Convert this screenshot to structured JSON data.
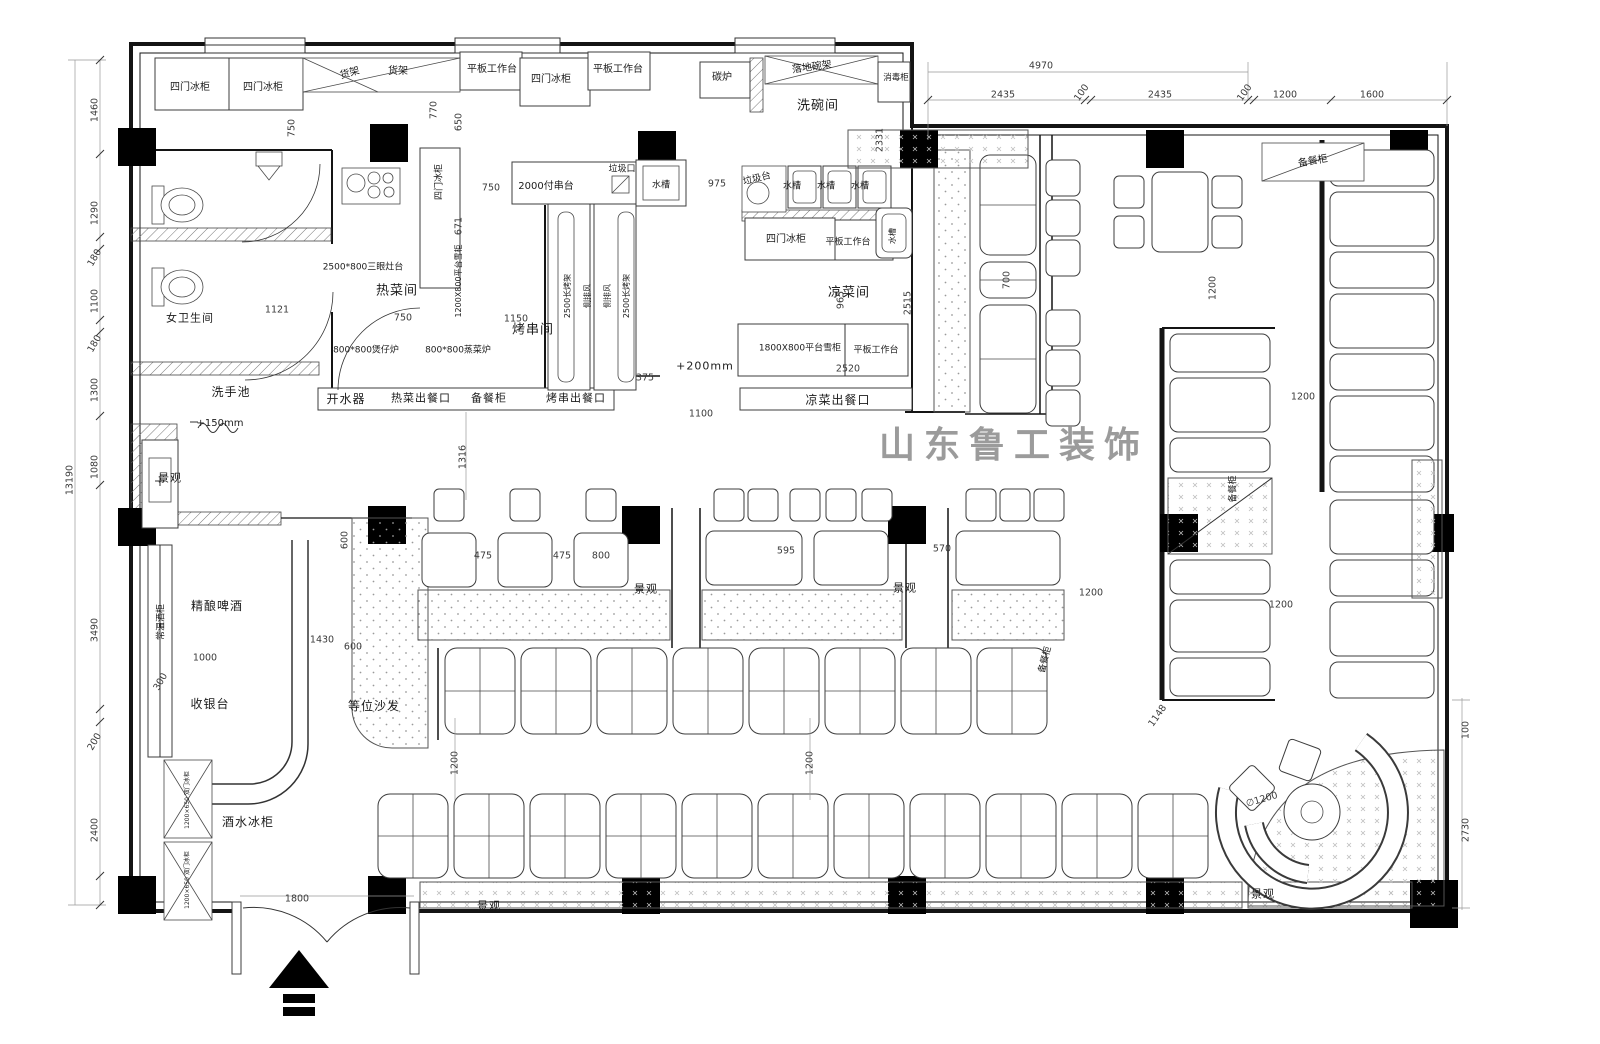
{
  "title": "restaurant-floor-plan",
  "watermark": "山东鲁工装饰",
  "entrance": {
    "width_label": "1800"
  },
  "labels": [
    {
      "id": "fridge-4door-1",
      "t": "四门冰柜",
      "x": 190,
      "y": 88,
      "c": "e"
    },
    {
      "id": "fridge-4door-2",
      "t": "四门冰柜",
      "x": 263,
      "y": 88,
      "c": "e"
    },
    {
      "id": "shelf-rack-1",
      "t": "货架",
      "x": 350,
      "y": 74,
      "r": -16,
      "c": "e"
    },
    {
      "id": "shelf-rack-2",
      "t": "货架",
      "x": 398,
      "y": 72,
      "c": "e"
    },
    {
      "id": "worktable-1",
      "t": "平板工作台",
      "x": 492,
      "y": 70,
      "c": "e"
    },
    {
      "id": "fridge-4door-3",
      "t": "四门冰柜",
      "x": 551,
      "y": 80,
      "c": "e"
    },
    {
      "id": "worktable-2",
      "t": "平板工作台",
      "x": 618,
      "y": 70,
      "c": "e"
    },
    {
      "id": "charcoal-stove",
      "t": "碳炉",
      "x": 722,
      "y": 78,
      "c": "e"
    },
    {
      "id": "floor-dish-rack",
      "t": "落地碗架",
      "x": 812,
      "y": 68,
      "r": -8,
      "c": "e"
    },
    {
      "id": "sterilizer-cabinet",
      "t": "消毒柜",
      "x": 896,
      "y": 78,
      "c": "e",
      "fs": 8.5
    },
    {
      "id": "dishwash-room",
      "t": "洗碗间",
      "x": 818,
      "y": 106,
      "c": "rm"
    },
    {
      "id": "trash-port",
      "t": "垃圾口",
      "x": 622,
      "y": 170,
      "c": "e",
      "fs": 9
    },
    {
      "id": "sink-1",
      "t": "水槽",
      "x": 661,
      "y": 186,
      "c": "e",
      "fs": 9
    },
    {
      "id": "skewer-counter",
      "t": "2000付串台",
      "x": 546,
      "y": 187,
      "c": "e"
    },
    {
      "id": "fridge-4door-4",
      "t": "四门冰柜",
      "x": 440,
      "y": 182,
      "r": -90,
      "c": "e",
      "fs": 9
    },
    {
      "id": "trash-table",
      "t": "垃圾台",
      "x": 757,
      "y": 179,
      "r": -14,
      "c": "e",
      "fs": 9.5
    },
    {
      "id": "sink-2",
      "t": "水槽",
      "x": 792,
      "y": 187,
      "c": "e",
      "fs": 9
    },
    {
      "id": "sink-3",
      "t": "水槽",
      "x": 826,
      "y": 187,
      "c": "e",
      "fs": 9
    },
    {
      "id": "sink-4",
      "t": "水槽",
      "x": 860,
      "y": 187,
      "c": "e",
      "fs": 9
    },
    {
      "id": "fridge-4door-5",
      "t": "四门冰柜",
      "x": 786,
      "y": 240,
      "c": "e"
    },
    {
      "id": "worktable-3",
      "t": "平板工作台",
      "x": 848,
      "y": 243,
      "c": "e",
      "fs": 9
    },
    {
      "id": "sink-5",
      "t": "水槽",
      "x": 893,
      "y": 236,
      "r": -90,
      "c": "e",
      "fs": 8
    },
    {
      "id": "stove-3eye",
      "t": "2500*800三眼灶台",
      "x": 363,
      "y": 268,
      "c": "e",
      "fs": 9
    },
    {
      "id": "hot-dish-room",
      "t": "热菜间",
      "x": 397,
      "y": 291,
      "c": "rm"
    },
    {
      "id": "platform-freezer-1",
      "t": "1200X800平台雪柜",
      "x": 459,
      "y": 281,
      "r": -90,
      "c": "e",
      "fs": 8
    },
    {
      "id": "bbq-skewer-room",
      "t": "烤串间",
      "x": 533,
      "y": 330,
      "c": "rm"
    },
    {
      "id": "claypot-stove",
      "t": "800*800煲仔炉",
      "x": 366,
      "y": 351,
      "c": "e",
      "fs": 9
    },
    {
      "id": "steam-stove",
      "t": "800*800蒸菜炉",
      "x": 458,
      "y": 351,
      "c": "e",
      "fs": 9
    },
    {
      "id": "grill-rack-1",
      "t": "2500长烤架",
      "x": 568,
      "y": 296,
      "r": -90,
      "c": "e",
      "fs": 8
    },
    {
      "id": "side-vent-1",
      "t": "侧排风",
      "x": 588,
      "y": 296,
      "r": -90,
      "c": "e",
      "fs": 8
    },
    {
      "id": "side-vent-2",
      "t": "侧排风",
      "x": 608,
      "y": 296,
      "r": -90,
      "c": "e",
      "fs": 8
    },
    {
      "id": "grill-rack-2",
      "t": "2500长烤架",
      "x": 627,
      "y": 296,
      "r": -90,
      "c": "e",
      "fs": 8
    },
    {
      "id": "cold-dish-room",
      "t": "凉菜间",
      "x": 849,
      "y": 293,
      "c": "rm"
    },
    {
      "id": "platform-freezer-2",
      "t": "1800X800平台雪柜",
      "x": 800,
      "y": 349,
      "c": "e",
      "fs": 9
    },
    {
      "id": "worktable-4",
      "t": "平板工作台",
      "x": 876,
      "y": 351,
      "c": "e",
      "fs": 9
    },
    {
      "id": "water-boiler",
      "t": "开水器",
      "x": 346,
      "y": 399,
      "c": "rm",
      "fs": 12
    },
    {
      "id": "hot-dish-window",
      "t": "热菜出餐口",
      "x": 421,
      "y": 398,
      "c": "rm",
      "fs": 11
    },
    {
      "id": "serving-cabinet-1",
      "t": "备餐柜",
      "x": 489,
      "y": 398,
      "c": "rm",
      "fs": 11
    },
    {
      "id": "bbq-serving-window",
      "t": "烤串出餐口",
      "x": 576,
      "y": 398,
      "c": "rm",
      "fs": 11
    },
    {
      "id": "cold-dish-window",
      "t": "凉菜出餐口",
      "x": 838,
      "y": 400,
      "c": "rm",
      "fs": 12
    },
    {
      "id": "womens-restroom",
      "t": "女卫生间",
      "x": 190,
      "y": 318,
      "c": "rm",
      "fs": 11
    },
    {
      "id": "wash-basin",
      "t": "洗手池",
      "x": 231,
      "y": 392,
      "c": "rm",
      "fs": 12
    },
    {
      "id": "level-note-150",
      "t": "+150mm",
      "x": 220,
      "y": 424,
      "c": "e",
      "fs": 10
    },
    {
      "id": "level-note-200",
      "t": "+200mm",
      "x": 705,
      "y": 366,
      "c": "rm",
      "fs": 11
    },
    {
      "id": "landscape-1",
      "t": "景观",
      "x": 170,
      "y": 478,
      "c": "rm",
      "fs": 11
    },
    {
      "id": "wine-cabinet",
      "t": "常温酒柜",
      "x": 162,
      "y": 622,
      "r": -90,
      "c": "e",
      "fs": 9
    },
    {
      "id": "craft-beer",
      "t": "精酿啤酒",
      "x": 217,
      "y": 606,
      "c": "rm",
      "fs": 12
    },
    {
      "id": "cashier-counter",
      "t": "收银台",
      "x": 210,
      "y": 704,
      "c": "rm",
      "fs": 12
    },
    {
      "id": "beverage-fridge",
      "t": "酒水冰柜",
      "x": 248,
      "y": 822,
      "c": "rm",
      "fs": 12
    },
    {
      "id": "fridge-2door-1",
      "t": "1200×650 双门冰柜",
      "x": 188,
      "y": 800,
      "r": -90,
      "c": "e",
      "fs": 6
    },
    {
      "id": "fridge-2door-2",
      "t": "1200×650 双门冰柜",
      "x": 188,
      "y": 880,
      "r": -90,
      "c": "e",
      "fs": 6
    },
    {
      "id": "waiting-sofa",
      "t": "等位沙发",
      "x": 374,
      "y": 706,
      "c": "rm",
      "fs": 12
    },
    {
      "id": "landscape-2",
      "t": "景观",
      "x": 646,
      "y": 589,
      "c": "rm",
      "fs": 11
    },
    {
      "id": "landscape-3",
      "t": "景观",
      "x": 905,
      "y": 588,
      "c": "rm",
      "fs": 11
    },
    {
      "id": "landscape-4",
      "t": "景观",
      "x": 489,
      "y": 906,
      "c": "rm",
      "fs": 11
    },
    {
      "id": "landscape-5",
      "t": "景观",
      "x": 1263,
      "y": 894,
      "c": "rm",
      "fs": 11
    },
    {
      "id": "serving-cabinet-2",
      "t": "备餐柜",
      "x": 1313,
      "y": 162,
      "r": -10,
      "c": "e"
    },
    {
      "id": "serving-cabinet-3",
      "t": "备餐柜",
      "x": 1234,
      "y": 489,
      "r": -90,
      "c": "e",
      "fs": 9
    },
    {
      "id": "serving-cabinet-4",
      "t": "备餐柜",
      "x": 1046,
      "y": 660,
      "r": -75,
      "c": "e",
      "fs": 9
    },
    {
      "id": "dim-4970",
      "t": "4970",
      "x": 1041,
      "y": 66,
      "c": "d"
    },
    {
      "id": "dim-2435a",
      "t": "2435",
      "x": 1003,
      "y": 95,
      "c": "d"
    },
    {
      "id": "dim-100a",
      "t": "100",
      "x": 1082,
      "y": 93,
      "r": -55,
      "c": "d"
    },
    {
      "id": "dim-2435b",
      "t": "2435",
      "x": 1160,
      "y": 95,
      "c": "d"
    },
    {
      "id": "dim-100b",
      "t": "100",
      "x": 1245,
      "y": 93,
      "r": -55,
      "c": "d"
    },
    {
      "id": "dim-1200a",
      "t": "1200",
      "x": 1285,
      "y": 95,
      "c": "d"
    },
    {
      "id": "dim-1600",
      "t": "1600",
      "x": 1372,
      "y": 95,
      "c": "d"
    },
    {
      "id": "dim-13190",
      "t": "13190",
      "x": 70,
      "y": 480,
      "r": -90,
      "c": "d"
    },
    {
      "id": "dim-1460",
      "t": "1460",
      "x": 95,
      "y": 110,
      "r": -90,
      "c": "d"
    },
    {
      "id": "dim-1290",
      "t": "1290",
      "x": 95,
      "y": 213,
      "r": -90,
      "c": "d"
    },
    {
      "id": "dim-180a",
      "t": "180",
      "x": 95,
      "y": 258,
      "r": -60,
      "c": "d"
    },
    {
      "id": "dim-1100a",
      "t": "1100",
      "x": 95,
      "y": 301,
      "r": -90,
      "c": "d"
    },
    {
      "id": "dim-180b",
      "t": "180",
      "x": 95,
      "y": 344,
      "r": -60,
      "c": "d"
    },
    {
      "id": "dim-1300",
      "t": "1300",
      "x": 95,
      "y": 390,
      "r": -90,
      "c": "d"
    },
    {
      "id": "dim-1080",
      "t": "1080",
      "x": 95,
      "y": 467,
      "r": -90,
      "c": "d"
    },
    {
      "id": "dim-3490",
      "t": "3490",
      "x": 95,
      "y": 630,
      "r": -90,
      "c": "d"
    },
    {
      "id": "dim-200",
      "t": "200",
      "x": 95,
      "y": 742,
      "r": -60,
      "c": "d"
    },
    {
      "id": "dim-2400",
      "t": "2400",
      "x": 95,
      "y": 830,
      "r": -90,
      "c": "d"
    },
    {
      "id": "dim-750a",
      "t": "750",
      "x": 292,
      "y": 128,
      "r": -90,
      "c": "d"
    },
    {
      "id": "dim-770",
      "t": "770",
      "x": 434,
      "y": 110,
      "r": -90,
      "c": "d"
    },
    {
      "id": "dim-650",
      "t": "650",
      "x": 459,
      "y": 122,
      "r": -90,
      "c": "d"
    },
    {
      "id": "dim-750b",
      "t": "750",
      "x": 491,
      "y": 188,
      "c": "d"
    },
    {
      "id": "dim-671",
      "t": "671",
      "x": 459,
      "y": 226,
      "r": -90,
      "c": "d"
    },
    {
      "id": "dim-975",
      "t": "975",
      "x": 717,
      "y": 184,
      "c": "d"
    },
    {
      "id": "dim-2331",
      "t": "2331",
      "x": 880,
      "y": 140,
      "r": -90,
      "c": "d"
    },
    {
      "id": "dim-1121",
      "t": "1121",
      "x": 277,
      "y": 310,
      "c": "d"
    },
    {
      "id": "dim-750c",
      "t": "750",
      "x": 403,
      "y": 318,
      "c": "d"
    },
    {
      "id": "dim-1150",
      "t": "1150",
      "x": 516,
      "y": 319,
      "c": "d"
    },
    {
      "id": "dim-965",
      "t": "965",
      "x": 841,
      "y": 300,
      "r": -90,
      "c": "d"
    },
    {
      "id": "dim-2515",
      "t": "2515",
      "x": 908,
      "y": 303,
      "r": -90,
      "c": "d"
    },
    {
      "id": "dim-2520",
      "t": "2520",
      "x": 848,
      "y": 369,
      "c": "d"
    },
    {
      "id": "dim-375",
      "t": "375",
      "x": 645,
      "y": 378,
      "c": "d"
    },
    {
      "id": "dim-1100b",
      "t": "1100",
      "x": 701,
      "y": 414,
      "c": "d"
    },
    {
      "id": "dim-1316",
      "t": "1316",
      "x": 463,
      "y": 457,
      "r": -90,
      "c": "d"
    },
    {
      "id": "dim-475a",
      "t": "475",
      "x": 483,
      "y": 556,
      "c": "d"
    },
    {
      "id": "dim-475b",
      "t": "475",
      "x": 562,
      "y": 556,
      "c": "d"
    },
    {
      "id": "dim-800",
      "t": "800",
      "x": 601,
      "y": 556,
      "c": "d"
    },
    {
      "id": "dim-595",
      "t": "595",
      "x": 786,
      "y": 551,
      "c": "d"
    },
    {
      "id": "dim-570",
      "t": "570",
      "x": 942,
      "y": 549,
      "c": "d"
    },
    {
      "id": "dim-600a",
      "t": "600",
      "x": 345,
      "y": 540,
      "r": -90,
      "c": "d"
    },
    {
      "id": "dim-1430",
      "t": "1430",
      "x": 322,
      "y": 640,
      "c": "d"
    },
    {
      "id": "dim-1000",
      "t": "1000",
      "x": 205,
      "y": 658,
      "c": "d"
    },
    {
      "id": "dim-600b",
      "t": "600",
      "x": 353,
      "y": 647,
      "c": "d"
    },
    {
      "id": "dim-300",
      "t": "300",
      "x": 161,
      "y": 682,
      "r": -60,
      "c": "d"
    },
    {
      "id": "dim-1800",
      "t": "1800",
      "x": 297,
      "y": 899,
      "c": "d"
    },
    {
      "id": "dim-1200b",
      "t": "1200",
      "x": 455,
      "y": 763,
      "r": -90,
      "c": "d"
    },
    {
      "id": "dim-1200c",
      "t": "1200",
      "x": 810,
      "y": 763,
      "r": -90,
      "c": "d"
    },
    {
      "id": "dim-700",
      "t": "700",
      "x": 1007,
      "y": 280,
      "r": -90,
      "c": "d"
    },
    {
      "id": "dim-1200d",
      "t": "1200",
      "x": 1213,
      "y": 288,
      "r": -90,
      "c": "d"
    },
    {
      "id": "dim-1200e",
      "t": "1200",
      "x": 1303,
      "y": 397,
      "c": "d"
    },
    {
      "id": "dim-1200f",
      "t": "1200",
      "x": 1091,
      "y": 593,
      "c": "d"
    },
    {
      "id": "dim-1200g",
      "t": "1200",
      "x": 1281,
      "y": 605,
      "c": "d"
    },
    {
      "id": "dim-1148",
      "t": "1148",
      "x": 1158,
      "y": 716,
      "r": -55,
      "c": "d"
    },
    {
      "id": "dim-d1200",
      "t": "∅1200",
      "x": 1262,
      "y": 800,
      "r": -16,
      "c": "d"
    },
    {
      "id": "dim-100c",
      "t": "100",
      "x": 1466,
      "y": 730,
      "r": -90,
      "c": "d"
    },
    {
      "id": "dim-2730",
      "t": "2730",
      "x": 1466,
      "y": 830,
      "r": -90,
      "c": "d"
    }
  ]
}
